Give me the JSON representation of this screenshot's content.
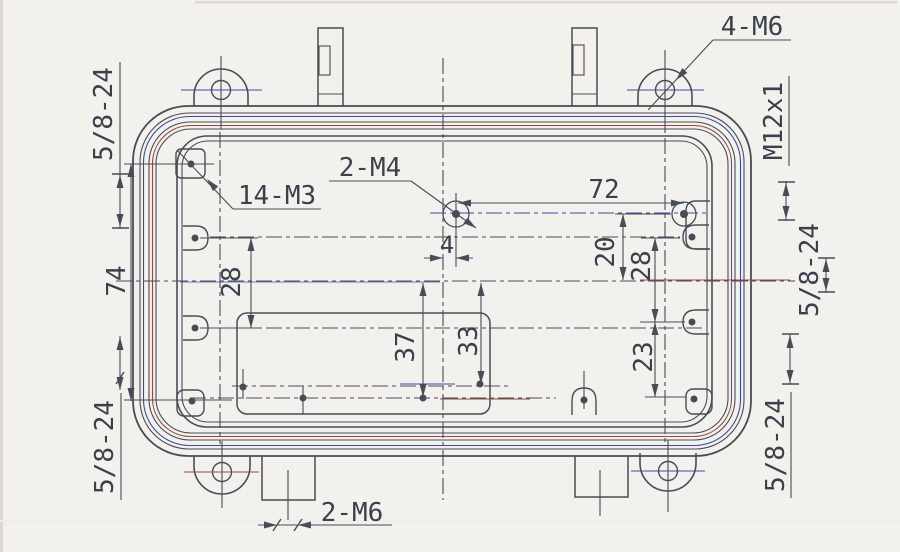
{
  "drawing": {
    "type": "engineering-dimension-drawing",
    "subject": "rectangular amplifier enclosure base, top view with lid seal grooves, mounting ears and screw bosses",
    "colors": {
      "paper": "#f3f1ed",
      "ink": "#474d56",
      "scan_blue": "#3c4b9c",
      "scan_red": "#94493f",
      "text": "#3b414b"
    },
    "callouts": {
      "four_m6": "4-M6",
      "fourteen_m3": "14-M3",
      "two_m4": "2-M4",
      "two_m6": "2-M6",
      "m12x1": "M12x1",
      "thread_top_left": "5/8-24",
      "thread_bottom_left": "5/8-24",
      "thread_mid_right": "5/8-24",
      "thread_bottom_right": "5/8-24"
    },
    "dimensions": {
      "width_72": "72",
      "height_74": "74",
      "left_28": "28",
      "right_20": "20",
      "right_28": "28",
      "right_23": "23",
      "center_37": "37",
      "center_33": "33",
      "offset_4": "4"
    }
  }
}
